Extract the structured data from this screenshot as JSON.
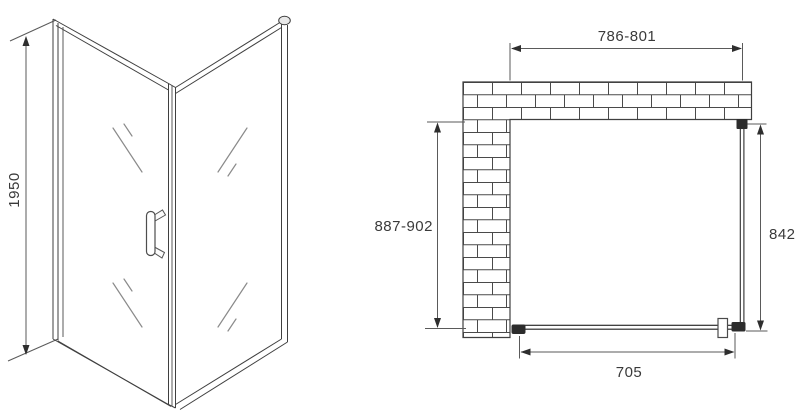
{
  "drawing": {
    "type": "shower-enclosure-technical-drawing",
    "front_view": {
      "height_label": "1950"
    },
    "plan_view": {
      "top_width_label": "786-801",
      "left_depth_label": "887-902",
      "right_panel_label": "842",
      "door_width_label": "705"
    },
    "colors": {
      "line": "#3f3f3f",
      "hardware": "#2c2c2c",
      "background": "#ffffff"
    }
  }
}
